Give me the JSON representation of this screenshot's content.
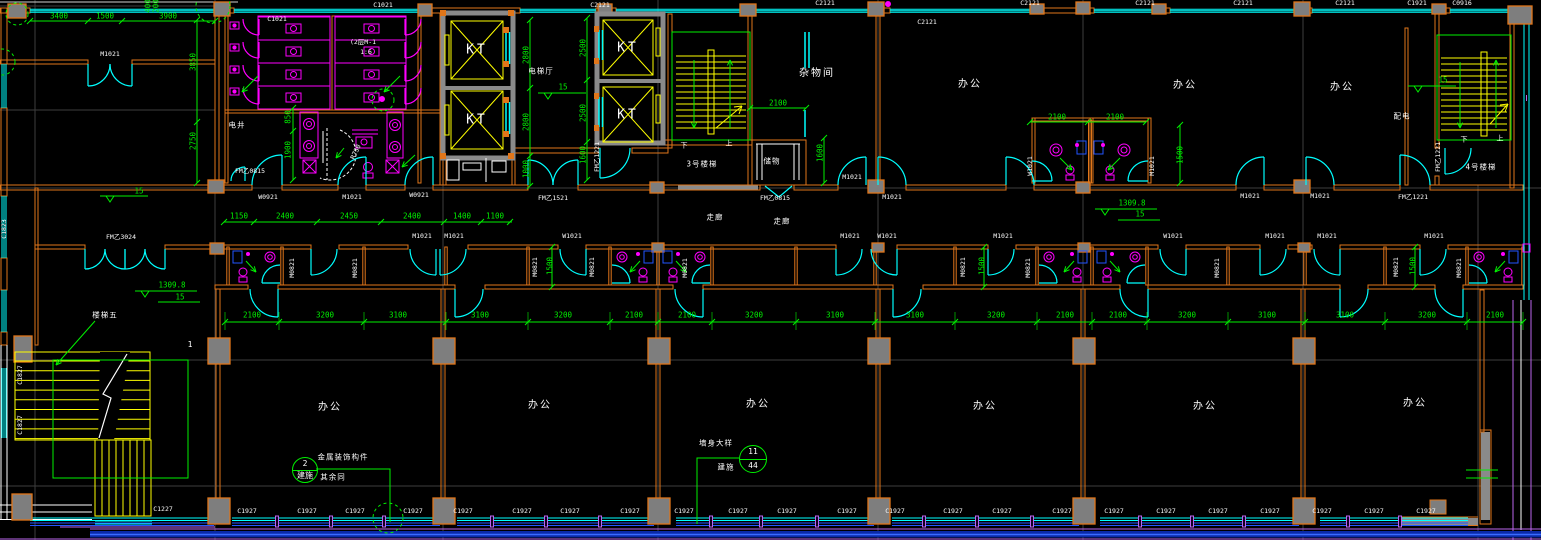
{
  "colors": {
    "wall": "#e0761a",
    "window": "#00ffff",
    "fixture": "#ff00ff",
    "dimension": "#00f000",
    "stair": "#ffff00",
    "text": "#ffffff",
    "shaft_blue": "#2255ff",
    "rail_violet": "#bb66ee"
  },
  "labels": [
    {
      "t": "杂物间",
      "x": 817,
      "y": 74,
      "c": "room"
    },
    {
      "t": "办公",
      "x": 970,
      "y": 85,
      "c": "room"
    },
    {
      "t": "办公",
      "x": 1185,
      "y": 86,
      "c": "room"
    },
    {
      "t": "办公",
      "x": 1342,
      "y": 88,
      "c": "room"
    },
    {
      "t": "办公",
      "x": 330,
      "y": 408,
      "c": "room"
    },
    {
      "t": "办公",
      "x": 540,
      "y": 406,
      "c": "room"
    },
    {
      "t": "办公",
      "x": 758,
      "y": 405,
      "c": "room"
    },
    {
      "t": "办公",
      "x": 985,
      "y": 407,
      "c": "room"
    },
    {
      "t": "办公",
      "x": 1205,
      "y": 407,
      "c": "room"
    },
    {
      "t": "办公",
      "x": 1415,
      "y": 404,
      "c": "room"
    },
    {
      "t": "电梯厅",
      "x": 541,
      "y": 71,
      "c": "small"
    },
    {
      "t": "走廊",
      "x": 715,
      "y": 217,
      "c": "small"
    },
    {
      "t": "走廊",
      "x": 782,
      "y": 221,
      "c": "small"
    },
    {
      "t": "3号楼梯",
      "x": 702,
      "y": 164,
      "c": "small"
    },
    {
      "t": "4号楼梯",
      "x": 1481,
      "y": 167,
      "c": "small"
    },
    {
      "t": "楼梯五",
      "x": 105,
      "y": 315,
      "c": "small"
    },
    {
      "t": "储物",
      "x": 772,
      "y": 161,
      "c": "small"
    },
    {
      "t": "电井",
      "x": 237,
      "y": 125,
      "c": "small"
    },
    {
      "t": "配电",
      "x": 1402,
      "y": 116,
      "c": "small"
    },
    {
      "t": "下",
      "x": 684,
      "y": 146,
      "c": "tiny"
    },
    {
      "t": "上",
      "x": 729,
      "y": 144,
      "c": "tiny"
    },
    {
      "t": "下",
      "x": 1464,
      "y": 140,
      "c": "tiny"
    },
    {
      "t": "上",
      "x": 1500,
      "y": 139,
      "c": "tiny"
    },
    {
      "t": "KT",
      "x": 477,
      "y": 50,
      "c": "elev"
    },
    {
      "t": "KT",
      "x": 477,
      "y": 120,
      "c": "elev"
    },
    {
      "t": "KT",
      "x": 628,
      "y": 48,
      "c": "elev"
    },
    {
      "t": "KT",
      "x": 628,
      "y": 115,
      "c": "elev"
    },
    {
      "t": "1",
      "x": 190,
      "y": 345,
      "c": "num"
    },
    {
      "t": "(2层M-1",
      "x": 363,
      "y": 42,
      "c": "code"
    },
    {
      "t": "1:6",
      "x": 366,
      "y": 52,
      "c": "code"
    },
    {
      "t": "R750",
      "x": 356,
      "y": 152,
      "c": "code",
      "r": -65
    },
    {
      "t": "C1021",
      "x": 277,
      "y": 19,
      "c": "code"
    },
    {
      "t": "C1021",
      "x": 383,
      "y": 5,
      "c": "code"
    },
    {
      "t": "C2121",
      "x": 600,
      "y": 5,
      "c": "code"
    },
    {
      "t": "C2121",
      "x": 825,
      "y": 3,
      "c": "code"
    },
    {
      "t": "C2121",
      "x": 927,
      "y": 22,
      "c": "code"
    },
    {
      "t": "C2121",
      "x": 1030,
      "y": 3,
      "c": "code"
    },
    {
      "t": "C2121",
      "x": 1145,
      "y": 3,
      "c": "code"
    },
    {
      "t": "C2121",
      "x": 1243,
      "y": 3,
      "c": "code"
    },
    {
      "t": "C2121",
      "x": 1345,
      "y": 3,
      "c": "code"
    },
    {
      "t": "C1921",
      "x": 1417,
      "y": 3,
      "c": "code"
    },
    {
      "t": "C0916",
      "x": 1462,
      "y": 3,
      "c": "code"
    },
    {
      "t": "M1021",
      "x": 110,
      "y": 54,
      "c": "code"
    },
    {
      "t": "W0921",
      "x": 268,
      "y": 197,
      "c": "code"
    },
    {
      "t": "M1021",
      "x": 352,
      "y": 197,
      "c": "code"
    },
    {
      "t": "W0921",
      "x": 419,
      "y": 195,
      "c": "code"
    },
    {
      "t": "FM乙1521",
      "x": 553,
      "y": 198,
      "c": "code"
    },
    {
      "t": "FM乙0815",
      "x": 775,
      "y": 198,
      "c": "code"
    },
    {
      "t": "FM乙0815",
      "x": 250,
      "y": 171,
      "c": "code"
    },
    {
      "t": "M1021",
      "x": 852,
      "y": 177,
      "c": "code"
    },
    {
      "t": "M1021",
      "x": 892,
      "y": 197,
      "c": "code"
    },
    {
      "t": "M1021",
      "x": 1250,
      "y": 196,
      "c": "code"
    },
    {
      "t": "M1021",
      "x": 1320,
      "y": 196,
      "c": "code"
    },
    {
      "t": "FM乙1221",
      "x": 1413,
      "y": 197,
      "c": "code"
    },
    {
      "t": "FM乙3024",
      "x": 121,
      "y": 237,
      "c": "code"
    },
    {
      "t": "M1021",
      "x": 422,
      "y": 236,
      "c": "code"
    },
    {
      "t": "M1021",
      "x": 454,
      "y": 236,
      "c": "code"
    },
    {
      "t": "W1021",
      "x": 572,
      "y": 236,
      "c": "code"
    },
    {
      "t": "M1021",
      "x": 850,
      "y": 236,
      "c": "code"
    },
    {
      "t": "W1021",
      "x": 887,
      "y": 236,
      "c": "code"
    },
    {
      "t": "M1021",
      "x": 1003,
      "y": 236,
      "c": "code"
    },
    {
      "t": "W1021",
      "x": 1173,
      "y": 236,
      "c": "code"
    },
    {
      "t": "M1021",
      "x": 1275,
      "y": 236,
      "c": "code"
    },
    {
      "t": "M1021",
      "x": 1327,
      "y": 236,
      "c": "code"
    },
    {
      "t": "M1021",
      "x": 1434,
      "y": 236,
      "c": "code"
    },
    {
      "t": "M0821",
      "x": 292,
      "y": 268,
      "c": "code",
      "r": -90
    },
    {
      "t": "M0821",
      "x": 355,
      "y": 268,
      "c": "code",
      "r": -90
    },
    {
      "t": "M0821",
      "x": 535,
      "y": 267,
      "c": "code",
      "r": -90
    },
    {
      "t": "M0821",
      "x": 592,
      "y": 267,
      "c": "code",
      "r": -90
    },
    {
      "t": "M0821",
      "x": 685,
      "y": 268,
      "c": "code",
      "r": -90
    },
    {
      "t": "M0821",
      "x": 963,
      "y": 267,
      "c": "code",
      "r": -90
    },
    {
      "t": "M0821",
      "x": 1028,
      "y": 268,
      "c": "code",
      "r": -90
    },
    {
      "t": "M0821",
      "x": 1217,
      "y": 268,
      "c": "code",
      "r": -90
    },
    {
      "t": "M0821",
      "x": 1396,
      "y": 267,
      "c": "code",
      "r": -90
    },
    {
      "t": "M0821",
      "x": 1459,
      "y": 268,
      "c": "code",
      "r": -90
    },
    {
      "t": "W1021",
      "x": 1030,
      "y": 166,
      "c": "code",
      "r": -90
    },
    {
      "t": "M1021",
      "x": 1152,
      "y": 166,
      "c": "code",
      "r": -90
    },
    {
      "t": "FM乙1221",
      "x": 1438,
      "y": 157,
      "c": "code",
      "r": -90
    },
    {
      "t": "FM乙1221",
      "x": 597,
      "y": 157,
      "c": "code",
      "r": -90
    },
    {
      "t": "C1823",
      "x": 4,
      "y": 229,
      "c": "code",
      "r": -90
    },
    {
      "t": "C1827",
      "x": 20,
      "y": 375,
      "c": "code",
      "r": -90
    },
    {
      "t": "C1827",
      "x": 20,
      "y": 425,
      "c": "code",
      "r": -90
    },
    {
      "t": "C1927",
      "x": 247,
      "y": 511,
      "c": "code"
    },
    {
      "t": "C1927",
      "x": 307,
      "y": 511,
      "c": "code"
    },
    {
      "t": "C1927",
      "x": 355,
      "y": 511,
      "c": "code"
    },
    {
      "t": "C1927",
      "x": 413,
      "y": 511,
      "c": "code"
    },
    {
      "t": "C1927",
      "x": 463,
      "y": 511,
      "c": "code"
    },
    {
      "t": "C1927",
      "x": 522,
      "y": 511,
      "c": "code"
    },
    {
      "t": "C1927",
      "x": 570,
      "y": 511,
      "c": "code"
    },
    {
      "t": "C1927",
      "x": 630,
      "y": 511,
      "c": "code"
    },
    {
      "t": "C1927",
      "x": 684,
      "y": 511,
      "c": "code"
    },
    {
      "t": "C1927",
      "x": 738,
      "y": 511,
      "c": "code"
    },
    {
      "t": "C1927",
      "x": 787,
      "y": 511,
      "c": "code"
    },
    {
      "t": "C1927",
      "x": 847,
      "y": 511,
      "c": "code"
    },
    {
      "t": "C1927",
      "x": 895,
      "y": 511,
      "c": "code"
    },
    {
      "t": "C1927",
      "x": 953,
      "y": 511,
      "c": "code"
    },
    {
      "t": "C1927",
      "x": 1002,
      "y": 511,
      "c": "code"
    },
    {
      "t": "C1927",
      "x": 1062,
      "y": 511,
      "c": "code"
    },
    {
      "t": "C1927",
      "x": 1114,
      "y": 511,
      "c": "code"
    },
    {
      "t": "C1927",
      "x": 1166,
      "y": 511,
      "c": "code"
    },
    {
      "t": "C1927",
      "x": 1218,
      "y": 511,
      "c": "code"
    },
    {
      "t": "C1927",
      "x": 1270,
      "y": 511,
      "c": "code"
    },
    {
      "t": "C1927",
      "x": 1322,
      "y": 511,
      "c": "code"
    },
    {
      "t": "C1927",
      "x": 1374,
      "y": 511,
      "c": "code"
    },
    {
      "t": "C1927",
      "x": 1426,
      "y": 511,
      "c": "code"
    },
    {
      "t": "C1227",
      "x": 163,
      "y": 509,
      "c": "code"
    },
    {
      "t": "3400",
      "x": 59,
      "y": 16,
      "c": "dim"
    },
    {
      "t": "1500",
      "x": 105,
      "y": 16,
      "c": "dim"
    },
    {
      "t": "3900",
      "x": 168,
      "y": 16,
      "c": "dim"
    },
    {
      "t": "400",
      "x": 148,
      "y": 6,
      "c": "dim",
      "r": -90
    },
    {
      "t": "200",
      "x": 156,
      "y": 6,
      "c": "dim",
      "r": -90
    },
    {
      "t": "3850",
      "x": 193,
      "y": 62,
      "c": "dim",
      "r": -90
    },
    {
      "t": "2750",
      "x": 193,
      "y": 141,
      "c": "dim",
      "r": -90
    },
    {
      "t": "1150",
      "x": 239,
      "y": 216,
      "c": "dim"
    },
    {
      "t": "2400",
      "x": 285,
      "y": 216,
      "c": "dim"
    },
    {
      "t": "2450",
      "x": 349,
      "y": 216,
      "c": "dim"
    },
    {
      "t": "2400",
      "x": 412,
      "y": 216,
      "c": "dim"
    },
    {
      "t": "1400",
      "x": 462,
      "y": 216,
      "c": "dim"
    },
    {
      "t": "1100",
      "x": 495,
      "y": 216,
      "c": "dim"
    },
    {
      "t": "850",
      "x": 288,
      "y": 117,
      "c": "dim",
      "r": -90
    },
    {
      "t": "1900",
      "x": 288,
      "y": 150,
      "c": "dim",
      "r": -90
    },
    {
      "t": "2800",
      "x": 526,
      "y": 55,
      "c": "dim",
      "r": -90
    },
    {
      "t": "2800",
      "x": 526,
      "y": 122,
      "c": "dim",
      "r": -90
    },
    {
      "t": "1000",
      "x": 526,
      "y": 169,
      "c": "dim",
      "r": -90
    },
    {
      "t": "2500",
      "x": 583,
      "y": 48,
      "c": "dim",
      "r": -90
    },
    {
      "t": "2500",
      "x": 583,
      "y": 113,
      "c": "dim",
      "r": -90
    },
    {
      "t": "1600",
      "x": 583,
      "y": 155,
      "c": "dim",
      "r": -90
    },
    {
      "t": "2100",
      "x": 778,
      "y": 103,
      "c": "dim"
    },
    {
      "t": "1600",
      "x": 820,
      "y": 153,
      "c": "dim",
      "r": -90
    },
    {
      "t": "2100",
      "x": 1057,
      "y": 117,
      "c": "dim"
    },
    {
      "t": "2100",
      "x": 1115,
      "y": 117,
      "c": "dim"
    },
    {
      "t": "1500",
      "x": 1180,
      "y": 155,
      "c": "dim",
      "r": -90
    },
    {
      "t": "2100",
      "x": 252,
      "y": 315,
      "c": "dim"
    },
    {
      "t": "3200",
      "x": 325,
      "y": 315,
      "c": "dim"
    },
    {
      "t": "3100",
      "x": 398,
      "y": 315,
      "c": "dim"
    },
    {
      "t": "3100",
      "x": 480,
      "y": 315,
      "c": "dim"
    },
    {
      "t": "3200",
      "x": 563,
      "y": 315,
      "c": "dim"
    },
    {
      "t": "2100",
      "x": 634,
      "y": 315,
      "c": "dim"
    },
    {
      "t": "2100",
      "x": 687,
      "y": 315,
      "c": "dim"
    },
    {
      "t": "3200",
      "x": 754,
      "y": 315,
      "c": "dim"
    },
    {
      "t": "3100",
      "x": 835,
      "y": 315,
      "c": "dim"
    },
    {
      "t": "3100",
      "x": 915,
      "y": 315,
      "c": "dim"
    },
    {
      "t": "3200",
      "x": 996,
      "y": 315,
      "c": "dim"
    },
    {
      "t": "2100",
      "x": 1065,
      "y": 315,
      "c": "dim"
    },
    {
      "t": "2100",
      "x": 1118,
      "y": 315,
      "c": "dim"
    },
    {
      "t": "3200",
      "x": 1187,
      "y": 315,
      "c": "dim"
    },
    {
      "t": "3100",
      "x": 1267,
      "y": 315,
      "c": "dim"
    },
    {
      "t": "3100",
      "x": 1345,
      "y": 315,
      "c": "dim"
    },
    {
      "t": "3200",
      "x": 1427,
      "y": 315,
      "c": "dim"
    },
    {
      "t": "2100",
      "x": 1495,
      "y": 315,
      "c": "dim"
    },
    {
      "t": "1500",
      "x": 550,
      "y": 266,
      "c": "dim",
      "r": -90
    },
    {
      "t": "1500",
      "x": 982,
      "y": 266,
      "c": "dim",
      "r": -90
    },
    {
      "t": "1500",
      "x": 1413,
      "y": 266,
      "c": "dim",
      "r": -90
    },
    {
      "t": "15",
      "x": 139,
      "y": 191,
      "c": "dim"
    },
    {
      "t": "15",
      "x": 563,
      "y": 87,
      "c": "dim"
    },
    {
      "t": "15",
      "x": 1443,
      "y": 80,
      "c": "dim"
    },
    {
      "t": "1309.8",
      "x": 172,
      "y": 285,
      "c": "dim"
    },
    {
      "t": "15",
      "x": 180,
      "y": 297,
      "c": "dim"
    },
    {
      "t": "1309.8",
      "x": 1132,
      "y": 203,
      "c": "dim"
    },
    {
      "t": "15",
      "x": 1140,
      "y": 214,
      "c": "dim"
    }
  ],
  "callouts": [
    {
      "top": "2",
      "bottom": "建施",
      "x": 304,
      "y": 469,
      "r": 12,
      "notes": [
        {
          "t": "金属装饰构件",
          "x": 343,
          "y": 457
        },
        {
          "t": "其余同",
          "x": 333,
          "y": 477
        }
      ],
      "leader": [
        [
          316,
          469
        ],
        [
          390,
          469
        ],
        [
          390,
          522
        ]
      ]
    },
    {
      "top": "11",
      "bottom": "44",
      "x": 752,
      "y": 458,
      "r": 13,
      "notes": [
        {
          "t": "墙身大样",
          "x": 716,
          "y": 443
        },
        {
          "t": "建施",
          "x": 726,
          "y": 467
        }
      ],
      "leader": [
        [
          739,
          458
        ],
        [
          697,
          458
        ],
        [
          697,
          524
        ]
      ]
    }
  ]
}
